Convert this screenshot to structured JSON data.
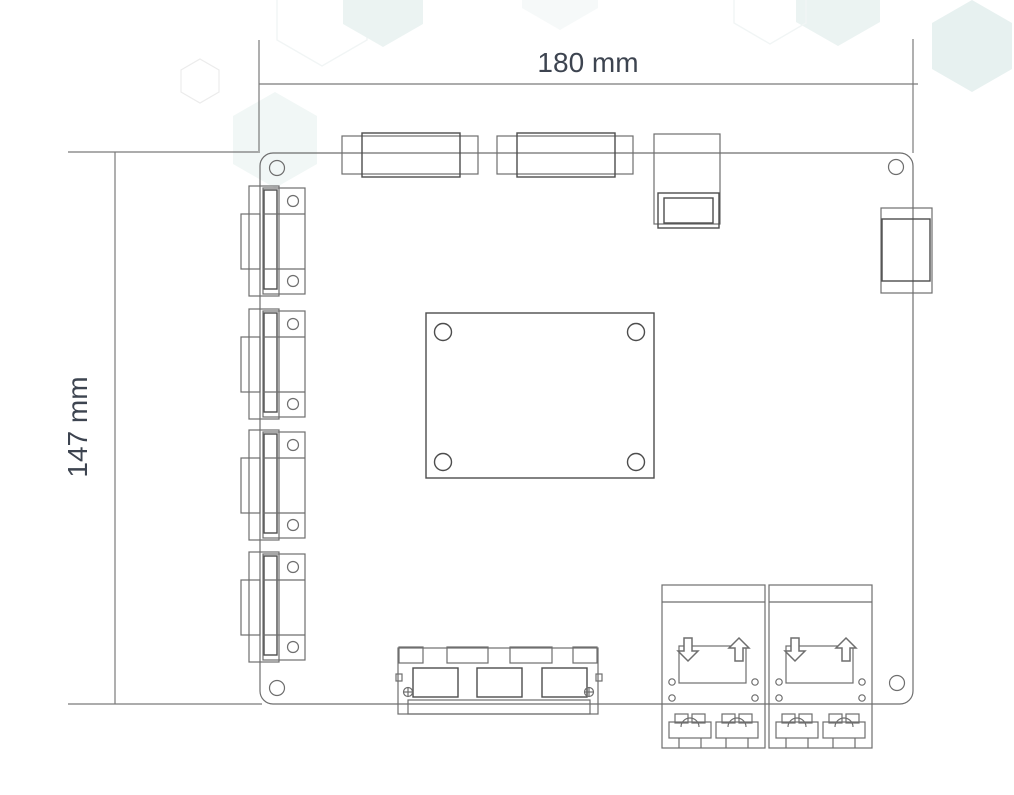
{
  "diagram": {
    "type": "pcb-dimension-drawing",
    "dimensions": {
      "width_label": "180 mm",
      "height_label": "147 mm"
    },
    "components": {
      "serial_connectors_left": 4,
      "top_header_blocks": 2,
      "usb_jack_top": 1,
      "right_edge_connector": 1,
      "cpu_mount_holes": 4,
      "bottom_port_block_ports": 3,
      "power_terminal_modules": 2,
      "corner_mounting_holes": 4
    },
    "icons": {
      "power_module_markings": [
        "arrow-down-icon",
        "arrow-up-icon"
      ]
    },
    "colors": {
      "background": "#ffffff",
      "dimension_line": "#7a7a7a",
      "outline": "#6e6e6e",
      "outline_dark": "#4d4d4d",
      "label_text": "#3d4450",
      "hexagon_fill": "#e7f1f0"
    }
  }
}
